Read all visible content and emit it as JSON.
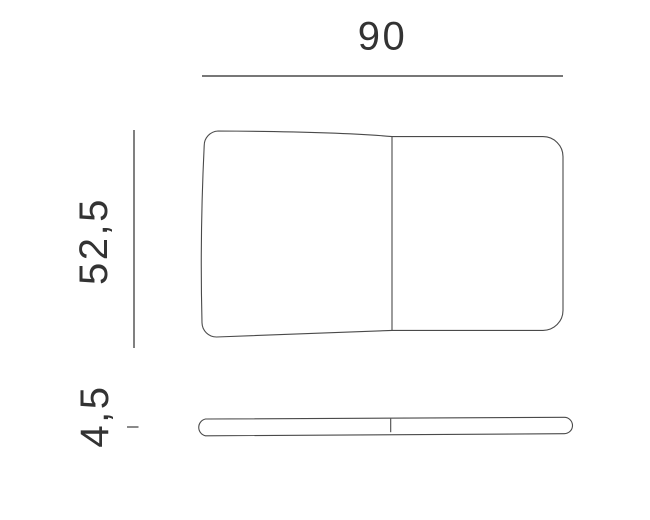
{
  "page": {
    "background_color": "#ffffff"
  },
  "diagram": {
    "type": "technical-dimension-drawing",
    "subject": "tabletop shown in top view and side profile view",
    "colors": {
      "line": "#4a4a4a",
      "text": "#333333"
    },
    "dimensions": {
      "width": {
        "label": "90"
      },
      "depth": {
        "label": "52,5"
      },
      "thickness": {
        "label": "4,5"
      }
    }
  }
}
